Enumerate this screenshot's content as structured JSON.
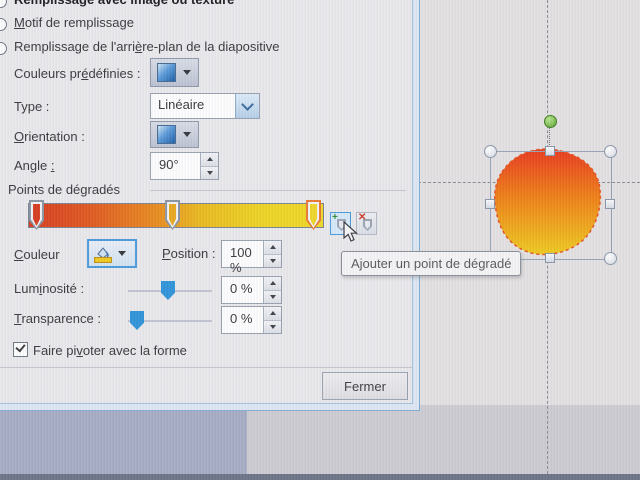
{
  "dialog": {
    "radios": [
      {
        "label": "Remplissage avec image ou texture"
      },
      {
        "pre": "",
        "u": "M",
        "post": "otif de remplissage"
      },
      {
        "pre": "Remplissage de l'arri",
        "u": "è",
        "post": "re-plan de la diapositive"
      }
    ],
    "preset_colors": {
      "pre": "Couleurs pr",
      "u": "é",
      "post": "définies :"
    },
    "type": {
      "label": "Type :",
      "value": "Linéaire"
    },
    "orientation": {
      "pre": "",
      "u": "O",
      "post": "rientation :"
    },
    "angle": {
      "pre": "Angle ",
      "u": ":",
      "post": "",
      "value": "90°"
    },
    "gradient_section_title": "Points de dégradés",
    "gradient_bar": {
      "stops": [
        {
          "position": "0 %",
          "color": "#d63a1e",
          "selected": false
        },
        {
          "position": "47 %",
          "color": "#e8a81e",
          "selected": false
        },
        {
          "position": "100 %",
          "color": "#eed628",
          "selected": true
        }
      ]
    },
    "color_row": {
      "pre": "",
      "u": "C",
      "post": "ouleur"
    },
    "position_row": {
      "pre": "",
      "u": "P",
      "post": "osition :",
      "value": "100 %"
    },
    "brightness": {
      "pre": "Lum",
      "u": "i",
      "post": "nosité :",
      "value": "0 %"
    },
    "transparency": {
      "pre": "",
      "u": "T",
      "post": "ransparence :",
      "value": "0 %"
    },
    "rotate_checkbox": {
      "pre": "Faire pi",
      "u": "v",
      "post": "oter avec la forme",
      "checked": true
    },
    "close_button": "Fermer",
    "tooltip": "Ajouter un point de dégradé",
    "icons": {
      "add_stop": "add-gradient-stop",
      "remove_stop": "remove-gradient-stop",
      "color_fill": "paint-bucket",
      "dropdown": "caret-down"
    },
    "colors": {
      "frame_accent": "#7fafd4",
      "selection_highlight": "#e87830",
      "slider_thumb": "#2e93d8"
    }
  },
  "canvas": {
    "shape_gradient_top": "#e8381c",
    "shape_gradient_mid": "#ee7e14",
    "shape_gradient_bottom": "#eeca1e",
    "shape_outline": "#e65020",
    "guide_color": "#8a8a94"
  }
}
